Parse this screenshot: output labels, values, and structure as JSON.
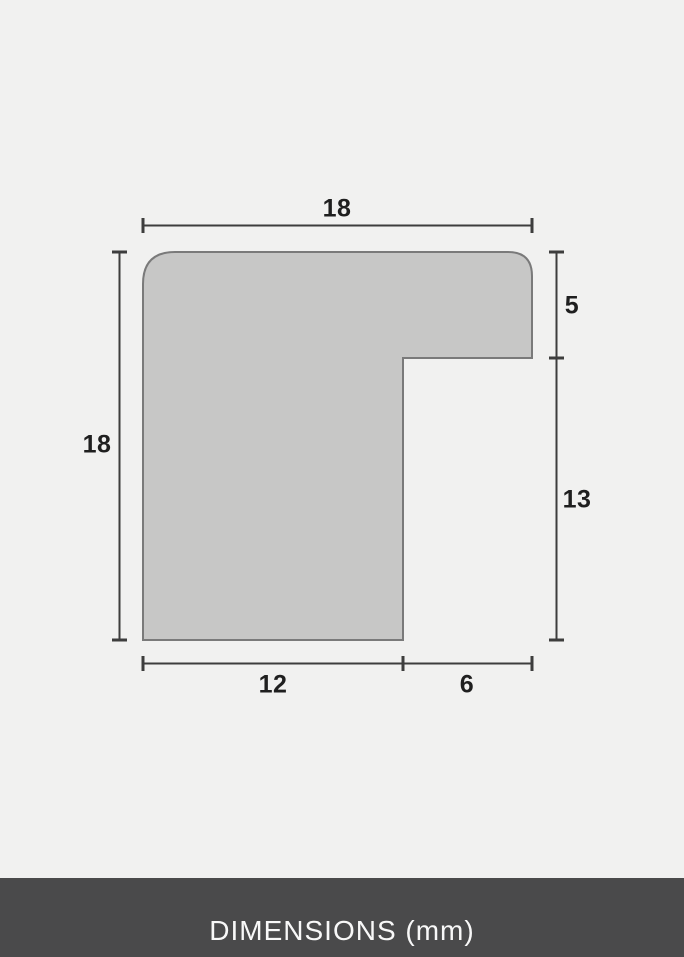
{
  "diagram": {
    "description": "Picture frame moulding profile cross-section with dimension lines",
    "labels": {
      "top_width": "18",
      "left_height": "18",
      "lip_height": "5",
      "rabbet_height": "13",
      "bottom_left_width": "12",
      "bottom_right_width": "6"
    }
  },
  "footer": {
    "label": "DIMENSIONS (mm)"
  },
  "colors": {
    "background": "#f1f1f0",
    "profile_fill": "#c7c7c6",
    "profile_stroke": "#7a7a7a",
    "dimension_line": "#3d3d3d",
    "label_text": "#1f1f1f",
    "footer_background": "#4a4a4b",
    "footer_text": "#f8f8f8"
  }
}
